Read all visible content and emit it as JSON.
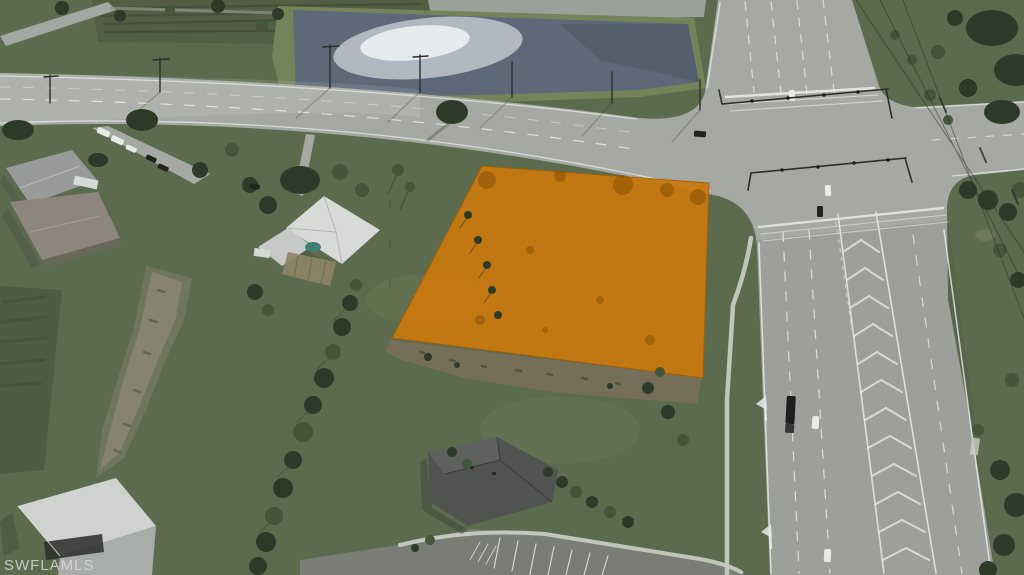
{
  "meta": {
    "description": "Aerial drone photograph of a vacant land parcel highlighted in orange at the corner of a residential road and a divided multi-lane highway, with a retention pond, scattered homes and green fields",
    "width": 1024,
    "height": 575
  },
  "watermark": {
    "text": "SWFLAMLS"
  },
  "scene": {
    "parcel_label": "highlighted-parcel",
    "features": [
      "retention-pond",
      "cross-road",
      "divided-highway",
      "signalized-intersection",
      "orange-highlighted-lot",
      "houses",
      "barn",
      "parking-lot",
      "tree-rows",
      "power-lines"
    ]
  },
  "colors": {
    "grass": "#5c6b4e",
    "grassLight": "#75835b",
    "grassDark": "#4c5640",
    "scrub": "#535e45",
    "road": "#a6a9a3",
    "marking": "#eceee9",
    "pond": "#5d6878",
    "glint": "#dfe4e6",
    "parcel": "#c9790f",
    "parcelDark": "#8f5206",
    "dirt": "#756e58",
    "mud": "#8b8672",
    "tree": "#2e3a28",
    "treeMid": "#44553a",
    "roofWhite": "#d7dad6",
    "roofGray": "#989b99",
    "roofBrown": "#8d867c",
    "roofDark": "#515350",
    "barnWhite": "#cfd2ce",
    "sidewalk": "#c7cabf",
    "parking": "#7a7d75",
    "vehicleDark": "#22251f",
    "vehicleWhite": "#e8eae6",
    "pole": "#2c2e2a",
    "watermark": "#dcdcdc"
  }
}
